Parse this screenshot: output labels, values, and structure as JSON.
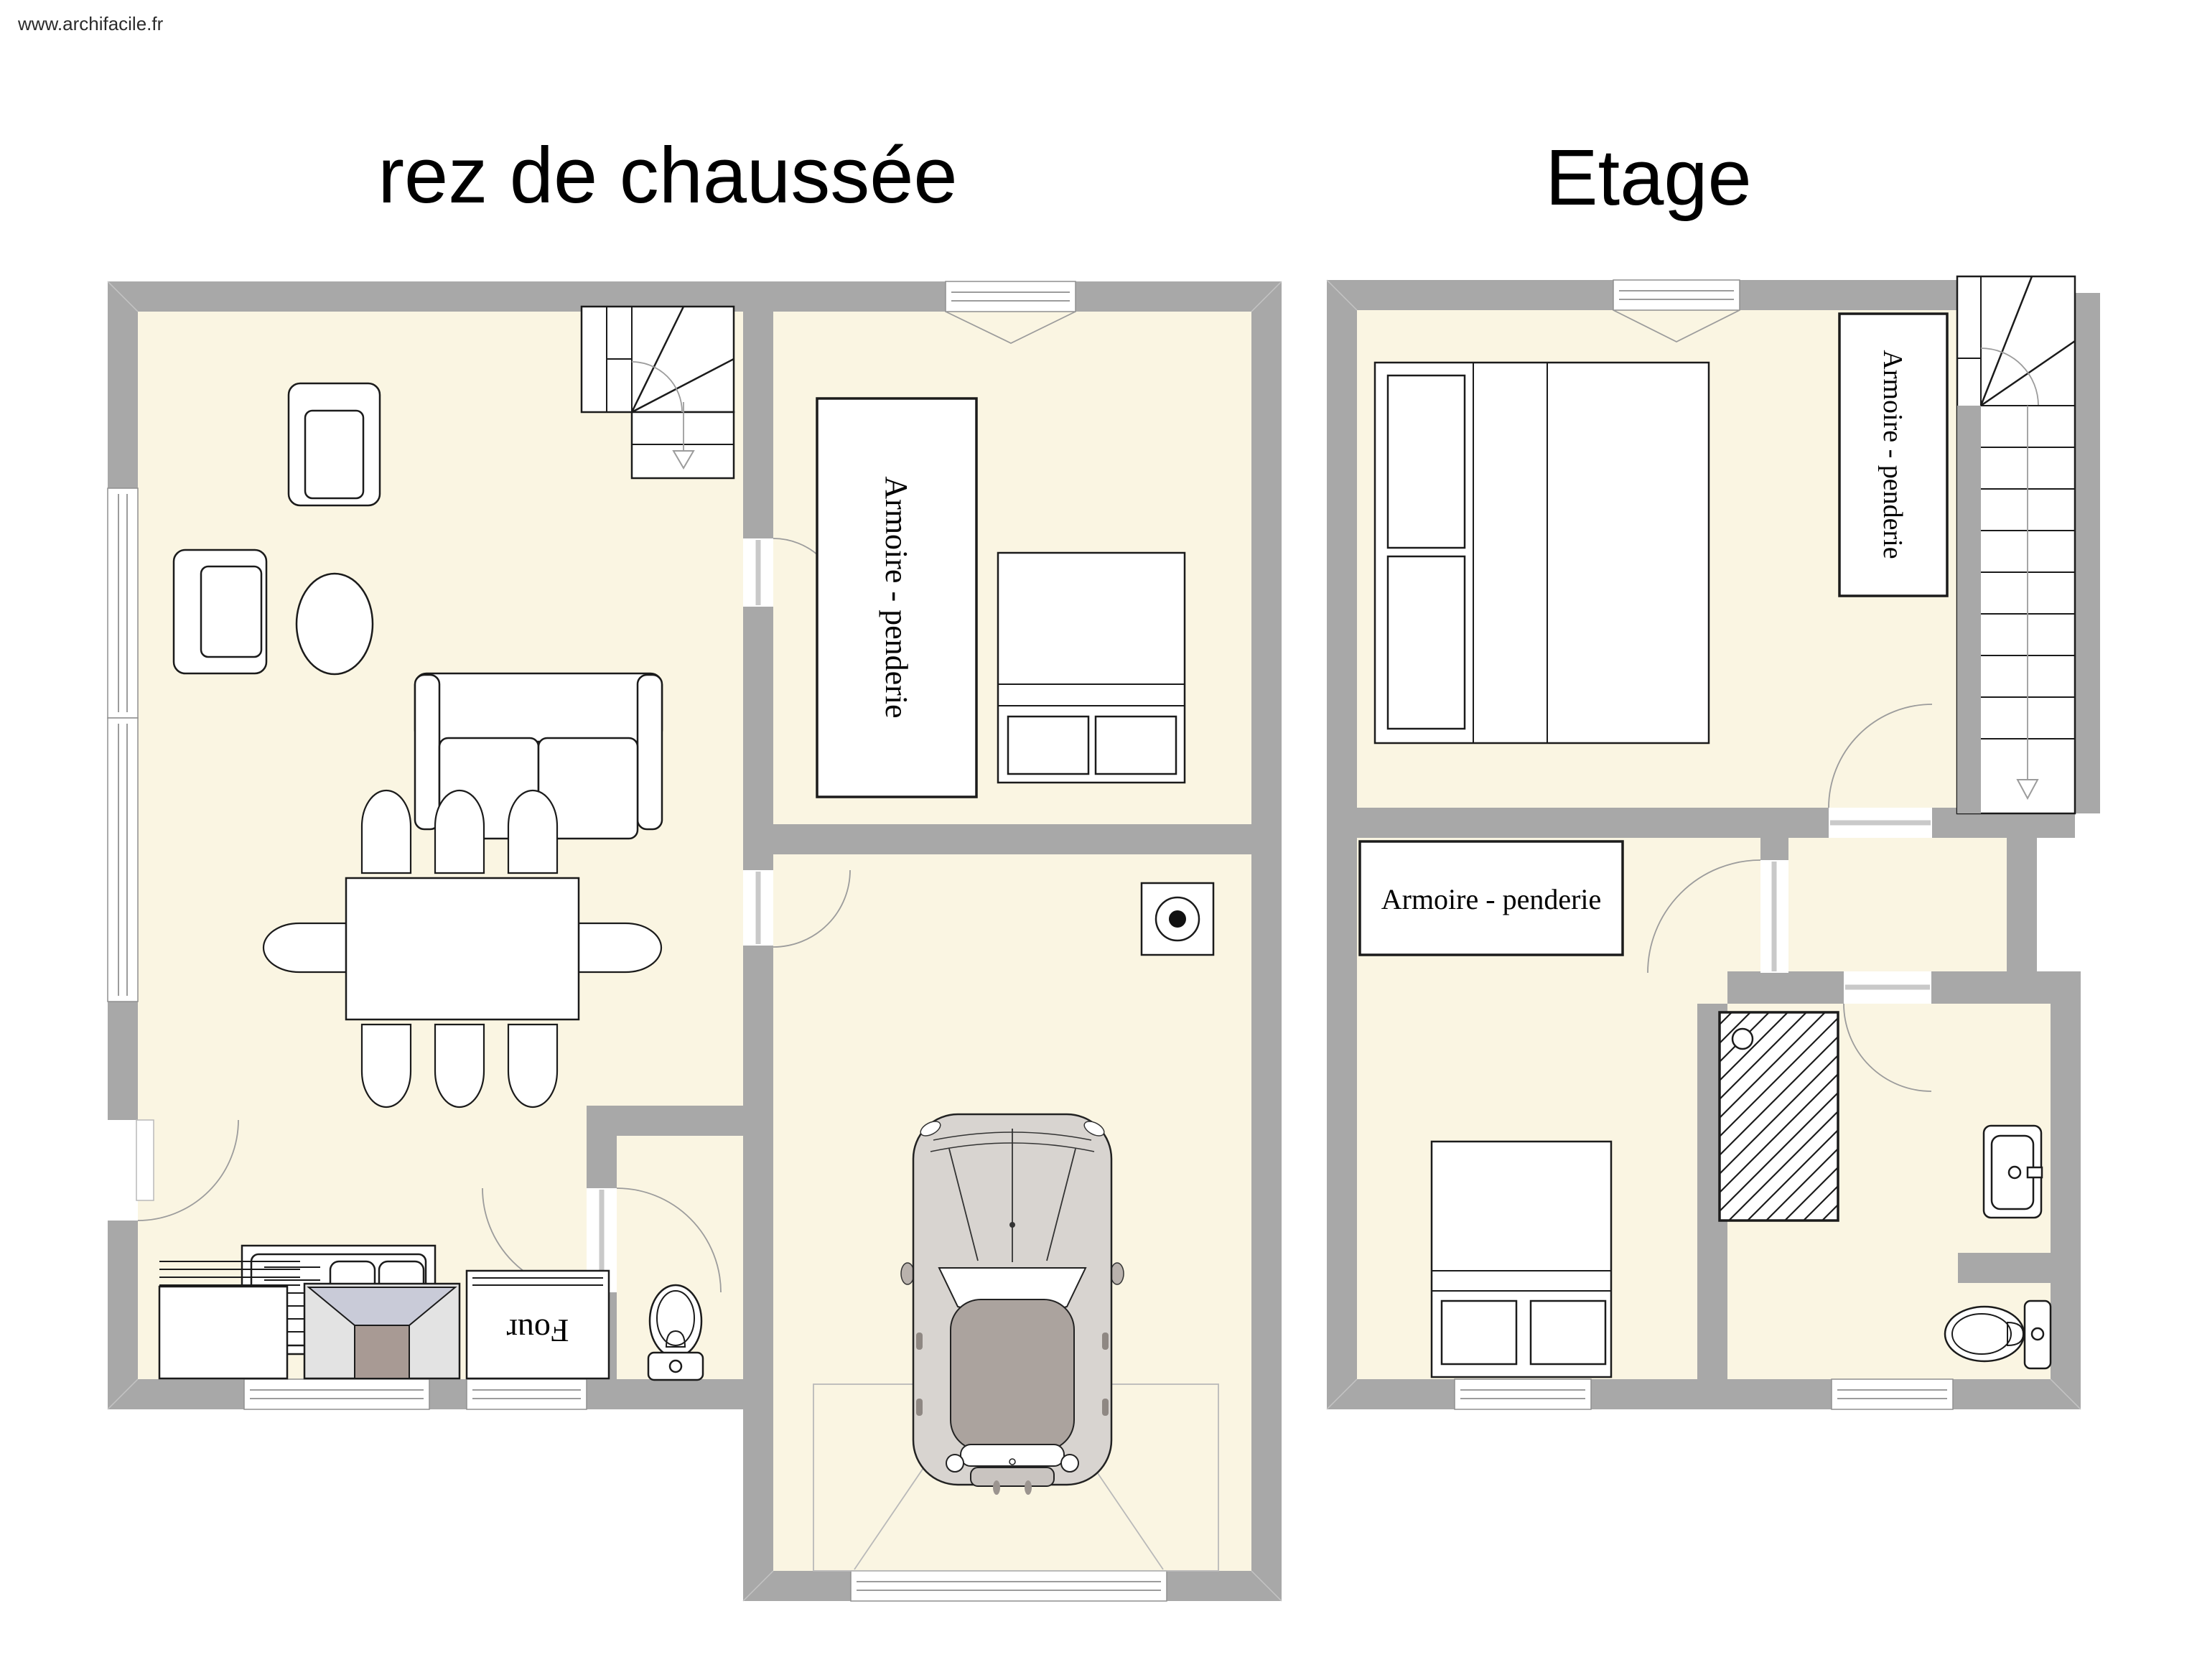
{
  "watermark": "www.archifacile.fr",
  "plans": {
    "ground": {
      "title": "rez de chaussée"
    },
    "upper": {
      "title": "Etage"
    }
  },
  "labels": {
    "wardrobe_ground": "Armoire - penderie",
    "wardrobe_upper_right": "Armoire - penderie",
    "wardrobe_upper_left": "Armoire - penderie",
    "oven": "Four"
  },
  "colors": {
    "wall": "#a8a8a8",
    "floor": "#faf5e2",
    "outline": "#1b1b1b",
    "door_arc": "#9c9c9c"
  }
}
